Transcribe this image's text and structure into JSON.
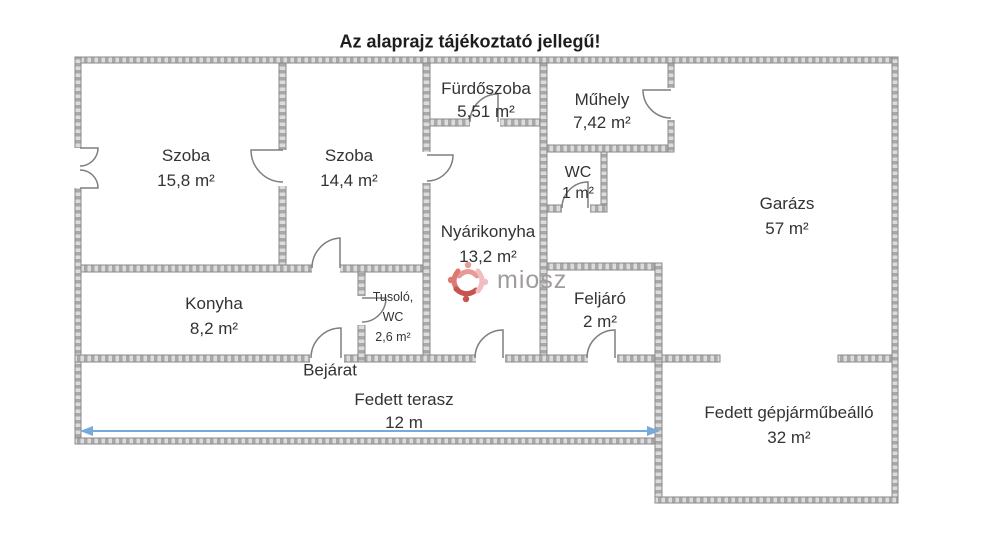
{
  "title": "Az alaprajz tájékoztató jellegű!",
  "watermark": {
    "brand": "miosz"
  },
  "rooms": {
    "szoba1": {
      "name": "Szoba",
      "area": "15,8 m²"
    },
    "szoba2": {
      "name": "Szoba",
      "area": "14,4 m²"
    },
    "furdoszoba": {
      "name": "Fürdőszoba",
      "area": "5,51 m²"
    },
    "muhely": {
      "name": "Műhely",
      "area": "7,42 m²"
    },
    "wc": {
      "name": "WC",
      "area": "1 m²"
    },
    "nyarikonyha": {
      "name": "Nyárikonyha",
      "area": "13,2 m²"
    },
    "garazs": {
      "name": "Garázs",
      "area": "57 m²"
    },
    "konyha": {
      "name": "Konyha",
      "area": "8,2 m²"
    },
    "tusolo": {
      "line1": "Tusoló,",
      "line2": "WC",
      "area": "2,6 m²"
    },
    "feljaro": {
      "name": "Feljáró",
      "area": "2 m²"
    },
    "bejarat": {
      "name": "Bejárat"
    },
    "terasz": {
      "name": "Fedett terasz",
      "dimension": "12 m"
    },
    "carport": {
      "name": "Fedett gépjárműbeálló",
      "area": "32 m²"
    }
  },
  "colors": {
    "wall_line": "#8a8a8a",
    "wall_fill_dark": "#a8a8a8",
    "wall_fill_light": "#dcdcdc",
    "door_line": "#7e7e7e",
    "text": "#333333",
    "dimension_arrow": "#76a9dc",
    "watermark_text": "#a09c9c"
  }
}
